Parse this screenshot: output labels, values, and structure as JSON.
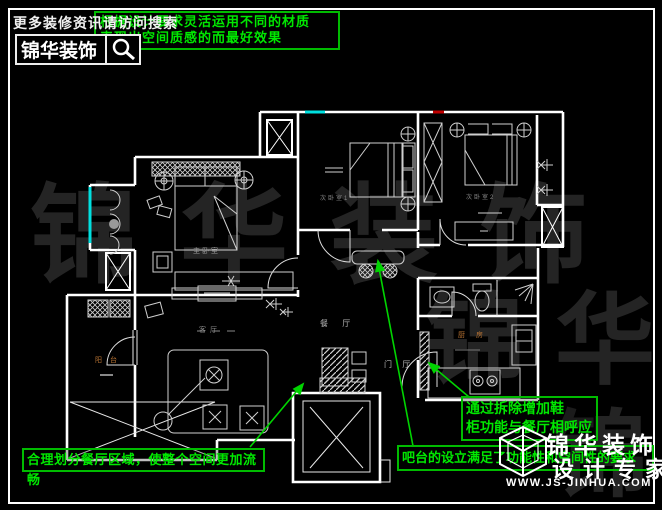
{
  "header": {
    "promo_text": "更多装修资讯请访问搜索",
    "tip_line1": "根据设计要求灵活运用不同的材质",
    "tip_line2": "表现出空间质感的而最好效果",
    "brand": "锦华装饰"
  },
  "floorplan": {
    "room_labels": {
      "master": "主卧室",
      "bedroom2": "次卧室1",
      "bedroom3": "次卧室2",
      "dining": "餐 厅",
      "foyer": "门 厅",
      "living": "客厅",
      "kitchen": "厨房",
      "balcony": "阳台"
    }
  },
  "annotations": {
    "dining_note": "合理划分餐厅区域，使整个空间更加流畅",
    "shoe_note_line1": "通过拆除增加鞋",
    "shoe_note_line2": "柜功能与餐厅相呼应",
    "bar_note": "吧台的设立满足了功能性和空间性的要求"
  },
  "watermark": {
    "text": "锦华装饰"
  },
  "footer": {
    "brand": "锦华装饰",
    "tagline": "设计专家",
    "website": "WWW.JS-JINHUA.COM"
  },
  "colors": {
    "annotation_green": "#00bb00",
    "window_cyan": "#00e0e0",
    "accent_red": "#c00000",
    "wall_white": "#ffffff"
  }
}
